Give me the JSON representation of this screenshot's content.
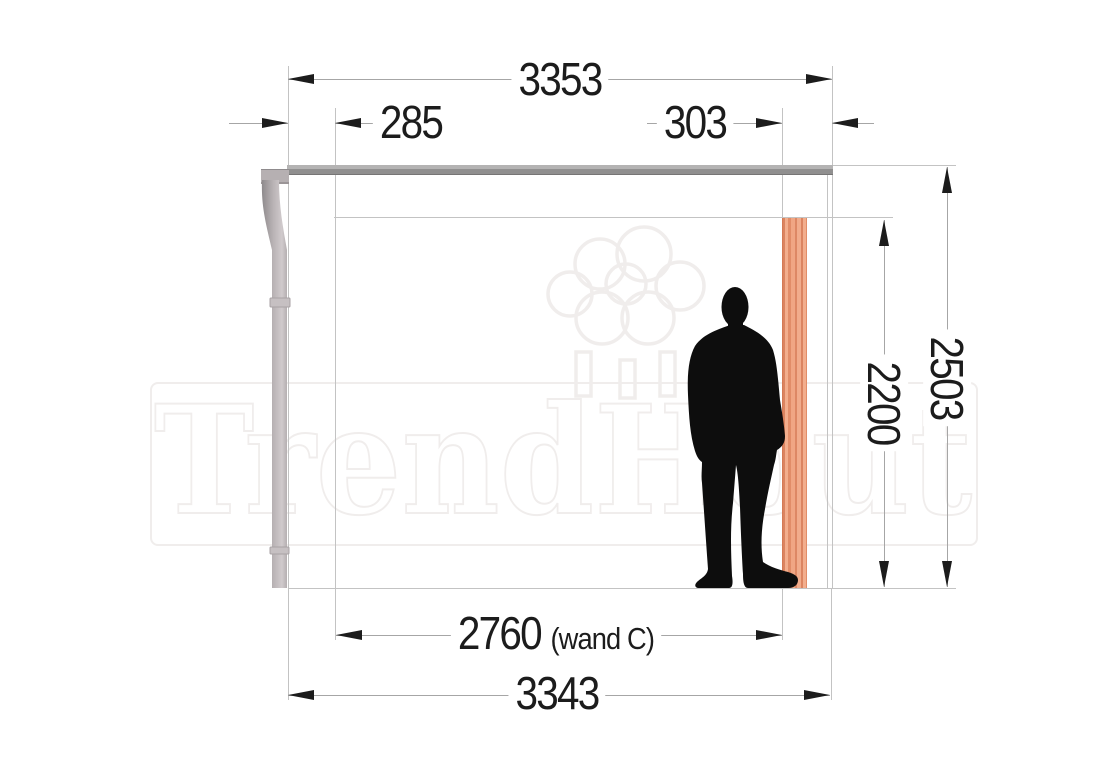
{
  "watermark": {
    "brand": "TrendHout"
  },
  "dims": {
    "roof_width": "3353",
    "left_offset": "285",
    "right_offset": "303",
    "total_height": "2503",
    "clear_height": "2200",
    "wall_width": "2760",
    "wall_note": "(wand C)",
    "base_width": "3343"
  },
  "colors": {
    "ink": "#1c1c1c",
    "line": "#c3c3c3",
    "dim_line": "#a6a6a6",
    "watermark_outline": "#f0edec",
    "roof_gray": "#a3a2a2",
    "pipe_gray": "#b6b0b2",
    "post_wood": "#eb9b78",
    "post_wood_dark": "#d47a55",
    "silhouette": "#0d0d0d"
  }
}
